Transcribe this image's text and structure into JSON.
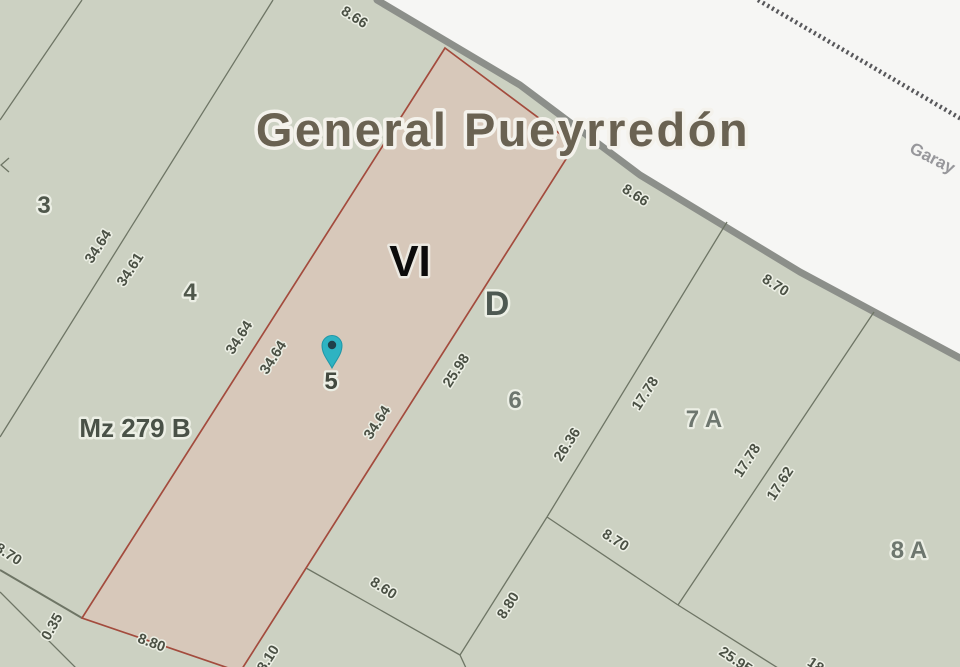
{
  "labels": {
    "municipality_title": "General Pueyrredón",
    "street_garay": "Garay",
    "block_code": "Mz 279 B",
    "section_roman": "VI",
    "zone_letter": "D"
  },
  "parcels": {
    "p3": "3",
    "p4": "4",
    "p5": "5",
    "p6": "6",
    "p7a": "7 A",
    "p8a": "8 A"
  },
  "dims": {
    "t866a": "8.66",
    "t866b": "8.66",
    "d3464a": "34.64",
    "d3461": "34.61",
    "d3464b": "34.64",
    "d3464c": "34.64",
    "d3464d": "34.64",
    "d2598": "25.98",
    "d2636": "26.36",
    "d1778a": "17.78",
    "d1778b": "17.78",
    "d1762": "17.62",
    "d870a": "8.70",
    "d870b": "8.70",
    "d870c": "8.70",
    "d860": "8.60",
    "d880a": "8.80",
    "d880b": "8.80",
    "d035": "0.35",
    "d810": "8.10",
    "d2595": "25.95",
    "d18": "18"
  },
  "colors": {
    "parcel_fill": "#ccd1c2",
    "selected_parcel_fill": "#d7c8ba",
    "selected_parcel_border": "#a34b3d",
    "boundary_line": "#6e7565",
    "road_edge_gray": "#8c8f8a",
    "offblock_white": "#f6f6f4",
    "railway_gray": "#57575a",
    "pin_teal": "#2eb3c2",
    "title_brown": "#6a6252"
  }
}
